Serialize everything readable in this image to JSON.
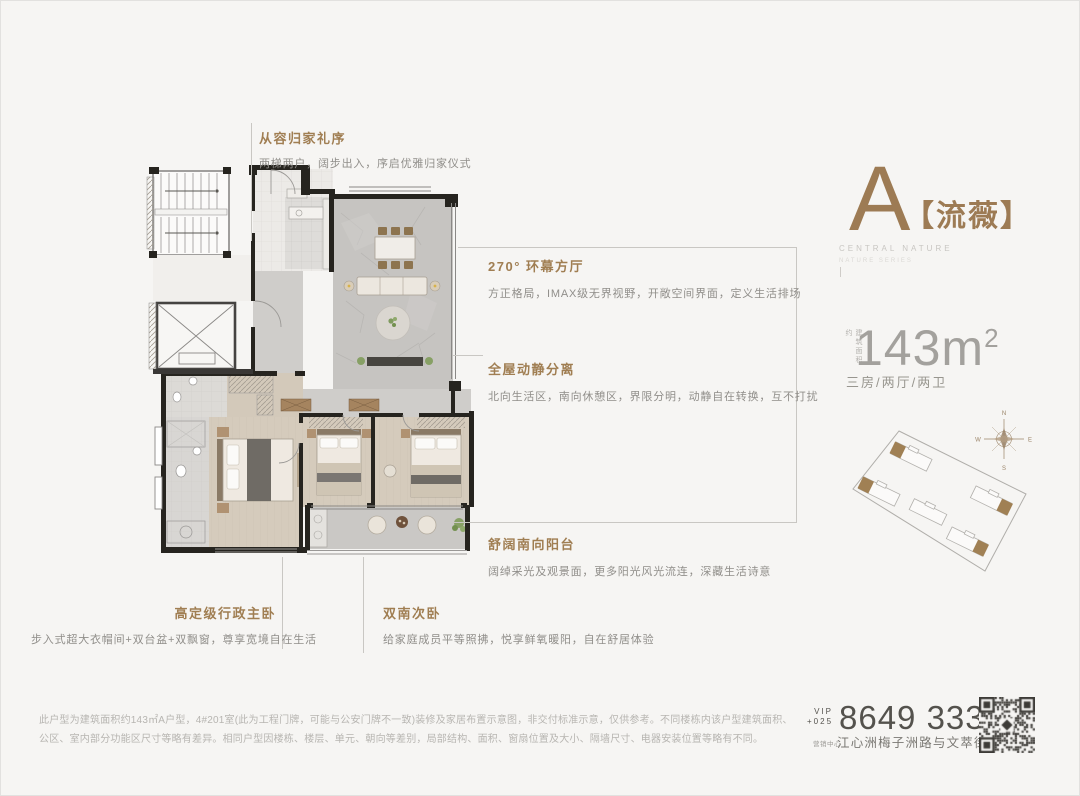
{
  "project": {
    "en_title": "CENTRAL NATURE",
    "en_subtitle": "NATURE SERIES"
  },
  "unit": {
    "letter": "A",
    "name": "【流薇】",
    "area_prefix": "建筑面积约",
    "area_value": "143m",
    "area_sup": "2",
    "layout": "三房/两厅/两卫"
  },
  "callouts": {
    "entry": {
      "title": "从容归家礼序",
      "desc": "两梯两户，阔步出入，序启优雅归家仪式"
    },
    "living": {
      "title": "270° 环幕方厅",
      "desc": "方正格局，IMAX级无界视野，开敞空间界面，定义生活排场"
    },
    "zoning": {
      "title": "全屋动静分离",
      "desc": "北向生活区，南向休憩区，界限分明，动静自在转换，互不打扰"
    },
    "balcony": {
      "title": "舒阔南向阳台",
      "desc": "阔绰采光及观景面，更多阳光风光流连，深藏生活诗意"
    },
    "master": {
      "title": "高定级行政主卧",
      "desc": "步入式超大衣帽间+双台盆+双飘窗，尊享宽境自在生活"
    },
    "second": {
      "title": "双南次卧",
      "desc": "给家庭成员平等照拂，悦享鲜氧暖阳，自在舒居体验"
    }
  },
  "siteplan": {
    "compass": {
      "n": "N",
      "e": "E",
      "s": "S",
      "w": "W"
    }
  },
  "contact": {
    "vip": "VIP",
    "city_code": "+025",
    "phone": "8649 3333",
    "address_tag": "营销中心",
    "address": "江心洲梅子洲路与文萃街交汇处"
  },
  "disclaimer": {
    "line1": "此户型为建筑面积约143㎡A户型，4#201室(此为工程门牌，可能与公安门牌不一致)装修及家居布置示意图，非交付标准示意，仅供参考。不同楼栋内该户型建筑面积、",
    "line2": "公区、室内部分功能区尺寸等略有差异。相同户型因楼栋、楼层、单元、朝向等差别，局部结构、面积、窗扇位置及大小、隔墙尺寸、电器安装位置等略有不同。"
  },
  "colors": {
    "accent_brown": "#a07e52",
    "title_brown": "#9d7b54",
    "wall_black": "#26241f",
    "text_gray": "#908e8a",
    "disclaimer_gray": "#b7b5b1",
    "phone_gray": "#54524d",
    "background": "#f6f5f3"
  }
}
